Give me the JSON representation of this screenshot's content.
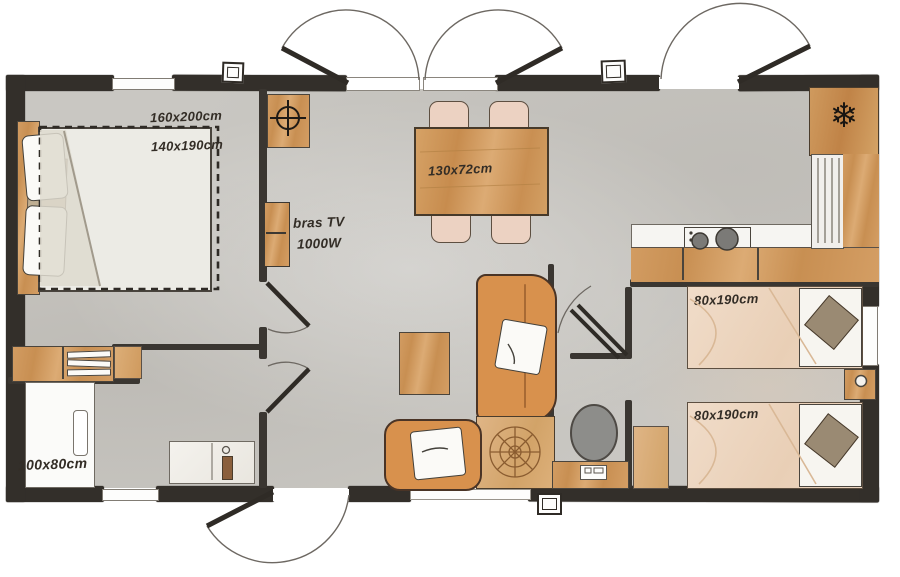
{
  "plan": {
    "type": "mobile-home-floor-plan",
    "rooms": {
      "master_bedroom": {
        "space_label": "160x200cm",
        "bed_label": "140x190cm"
      },
      "living": {
        "tv_label_line1": "bras TV",
        "tv_label_line2": "1000W",
        "table_label": "130x72cm"
      },
      "bedroom_top": {
        "bed_label": "80x190cm"
      },
      "bedroom_bottom": {
        "bed_label": "80x190cm"
      },
      "bathroom": {
        "shower_label": "100x80cm"
      }
    },
    "icons": {
      "freezer_glyph": "❄",
      "freezer_name": "snowflake-icon",
      "utility_name": "crosshair-icon"
    },
    "colors": {
      "wall": "#332f2a",
      "floor": "#c9c7c2",
      "wood": "#d09a60",
      "wood_light": "#ddb484",
      "sofa_orange": "#d8914d",
      "mattress_pink": "#eed8c5",
      "cushion_taupe": "#9a8a73",
      "counter_white": "#f6f5f2"
    }
  }
}
